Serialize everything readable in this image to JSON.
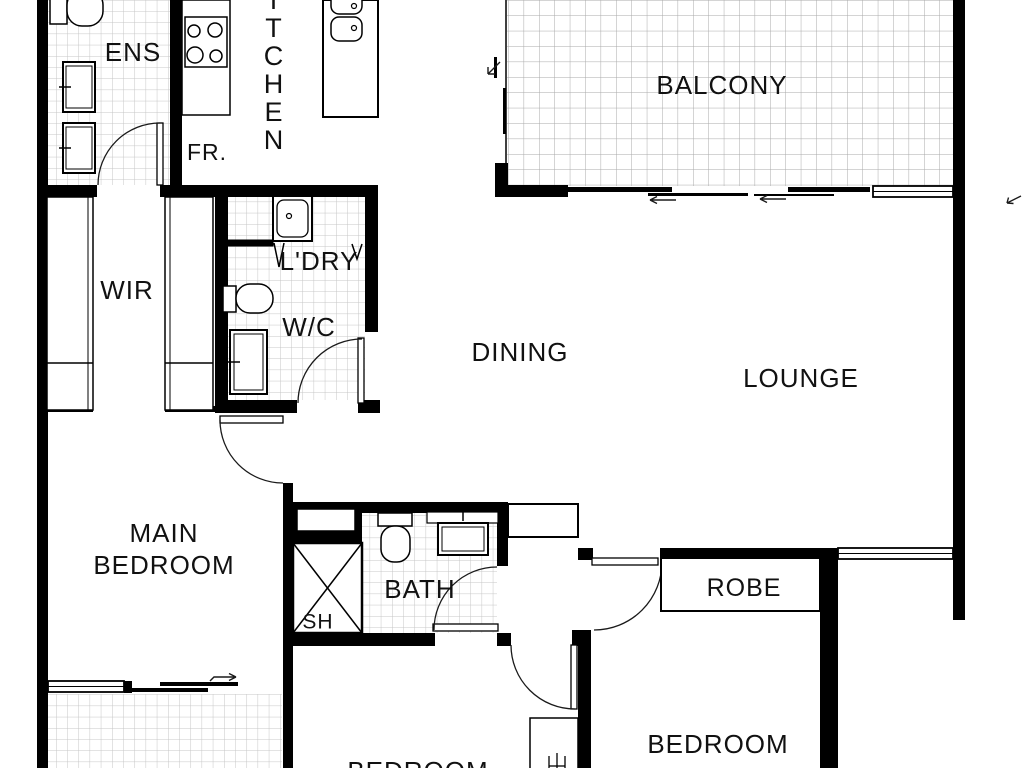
{
  "floor_plan": {
    "labels": {
      "ens": "ENS",
      "kitchen_letters": [
        "K",
        "I",
        "T",
        "C",
        "H",
        "E",
        "N"
      ],
      "fridge": "FR.",
      "balcony": "BALCONY",
      "wir": "WIR",
      "laundry": "L'DRY",
      "wc": "W/C",
      "dining": "DINING",
      "lounge": "LOUNGE",
      "main_bedroom_line1": "MAIN",
      "main_bedroom_line2": "BEDROOM",
      "bath": "BATH",
      "shower": "SH",
      "robe": "ROBE",
      "bedroom_mid": "BEDROOM",
      "bedroom_right": "BEDROOM"
    },
    "colors": {
      "wall": "#000000",
      "text": "#111111",
      "tile_line": "#c6c6c6",
      "balcony_tile_line": "#a9a9a9",
      "background": "#ffffff"
    }
  }
}
